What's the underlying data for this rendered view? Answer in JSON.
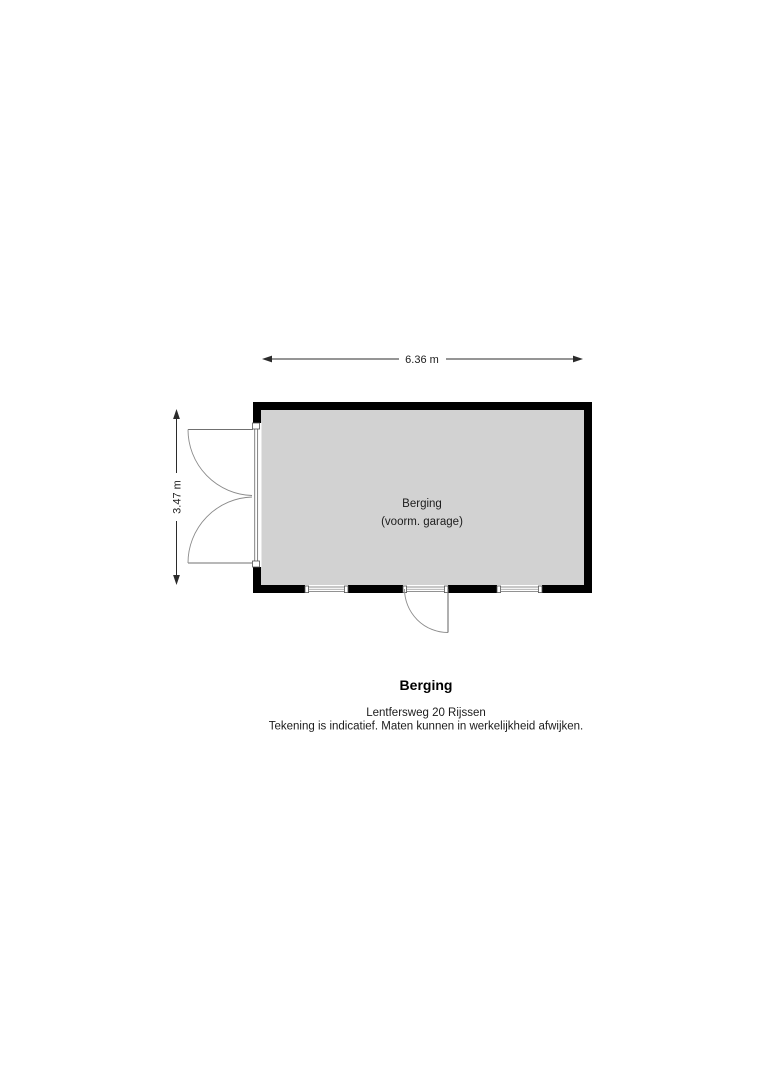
{
  "plan": {
    "dimensions": {
      "width_label": "6.36 m",
      "height_label": "3.47 m"
    },
    "room": {
      "name": "Berging",
      "subtitle": "(voorm. garage)"
    }
  },
  "footer": {
    "title": "Berging",
    "address": "Lentfersweg 20 Rijssen",
    "disclaimer": "Tekening is indicatief. Maten kunnen in werkelijkheid afwijken."
  },
  "colors": {
    "wall": "#000000",
    "floor": "#d2d2d2",
    "dimension-line": "#2b2b2b",
    "door-arc": "#8a8a8a",
    "door-leaf": "#707070",
    "frame": "#777777",
    "text": "#1c1c1c"
  }
}
